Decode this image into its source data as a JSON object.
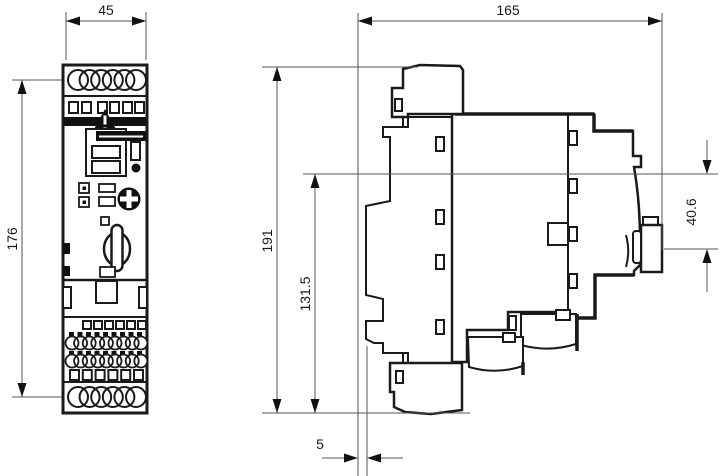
{
  "drawing": {
    "dimensions": {
      "front_width": {
        "value": "45",
        "orientation": "horizontal",
        "view": "front"
      },
      "front_height": {
        "value": "176",
        "orientation": "vertical",
        "view": "front"
      },
      "side_width": {
        "value": "165",
        "orientation": "horizontal",
        "view": "side"
      },
      "side_height": {
        "value": "191",
        "orientation": "vertical",
        "view": "side"
      },
      "side_inner_height": {
        "value": "131.5",
        "orientation": "vertical",
        "view": "side"
      },
      "terminal_block_height": {
        "value": "40.6",
        "orientation": "vertical",
        "view": "side"
      },
      "base_offset": {
        "value": "5",
        "orientation": "horizontal",
        "view": "side"
      }
    },
    "colors": {
      "line": "#1a1a1a",
      "dimension": "#555555",
      "background": "#ffffff"
    }
  }
}
